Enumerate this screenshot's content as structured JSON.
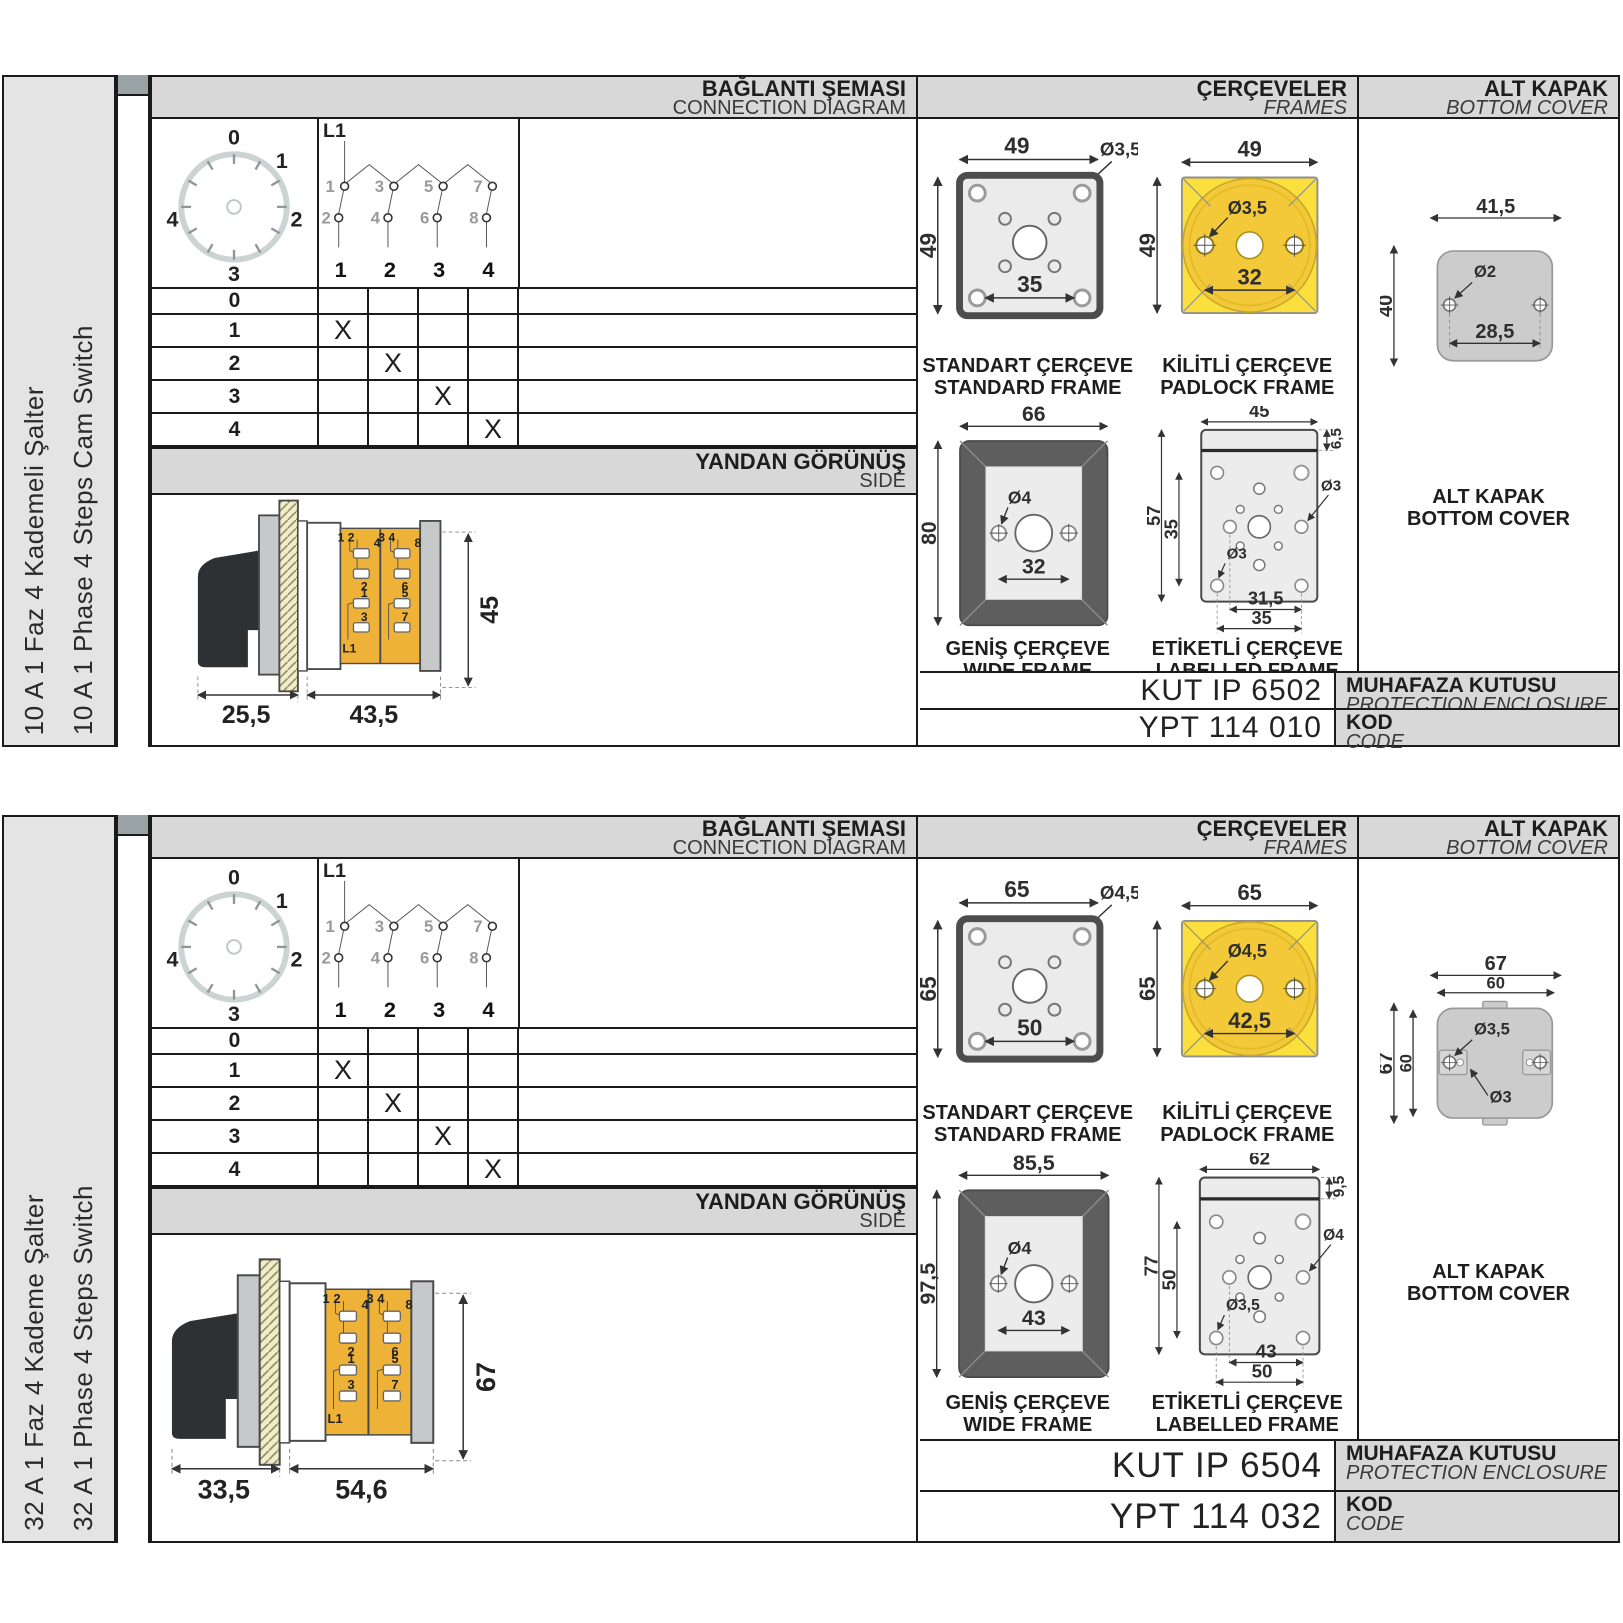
{
  "panels": [
    {
      "side_label_tr": "10 A 1 Faz 4 Kademeli Şalter",
      "side_label_en": "10 A 1 Phase 4 Steps Cam Switch",
      "headers": {
        "connection_tr": "BAĞLANTI ŞEMASI",
        "connection_en": "CONNECTION DIAGRAM",
        "frames_tr": "ÇERÇEVELER",
        "frames_en": "FRAMES",
        "cover_tr": "ALT KAPAK",
        "cover_en": "BOTTOM COVER"
      },
      "dial": {
        "positions": [
          "0",
          "1",
          "2",
          "3",
          "4"
        ]
      },
      "schematic": {
        "l1": "L1",
        "top": [
          "1",
          "3",
          "5",
          "7"
        ],
        "bottom": [
          "2",
          "4",
          "6",
          "8"
        ],
        "cols": [
          "1",
          "2",
          "3",
          "4"
        ]
      },
      "table": {
        "rows": [
          "0",
          "1",
          "2",
          "3",
          "4"
        ],
        "x_mark": "X"
      },
      "side_view": {
        "title_tr": "YANDAN GÖRÜNÜŞ",
        "title_en": "SIDE",
        "dim_front": "25,5",
        "dim_body": "43,5",
        "dim_height": "45",
        "t": {
          "pair_l": "1 2",
          "pair_r": "3 4",
          "t4": "4",
          "t2": "2",
          "t1": "1",
          "t3": "3",
          "t8": "8",
          "t6": "6",
          "t5": "5",
          "t7": "7",
          "l1": "L1"
        }
      },
      "frames": {
        "standard": {
          "caption_tr": "STANDART ÇERÇEVE",
          "caption_en": "STANDARD FRAME",
          "w": "49",
          "h": "49",
          "hole": "Ø3,5",
          "pitch": "35"
        },
        "padlock": {
          "caption_tr": "KİLİTLİ ÇERÇEVE",
          "caption_en": "PADLOCK FRAME",
          "w": "49",
          "h": "49",
          "hole": "Ø3,5",
          "pitch": "32"
        },
        "wide": {
          "caption_tr": "GENİŞ ÇERÇEVE",
          "caption_en": "WIDE FRAME",
          "w": "66",
          "h": "80",
          "hole": "Ø4",
          "pitch": "32"
        },
        "labelled": {
          "caption_tr": "ETİKETLİ ÇERÇEVE",
          "caption_en": "LABELLED FRAME",
          "w": "45",
          "strip": "6,5",
          "h": "57",
          "inner_h": "35",
          "hole_a": "Ø3",
          "hole_b": "Ø3",
          "pitch_a": "31,5",
          "pitch_b": "35"
        }
      },
      "cover": {
        "caption_tr": "ALT KAPAK",
        "caption_en": "BOTTOM COVER",
        "dim_top1": "41,5",
        "dim_left1": "40",
        "hole1": "Ø2",
        "dim_inner": "28,5"
      },
      "codes": {
        "enclosure_value": "KUT IP 6502",
        "enclosure_label_tr": "MUHAFAZA KUTUSU",
        "enclosure_label_en": "PROTECTION ENCLOSURE",
        "code_value": "YPT 114 010",
        "code_label_tr": "KOD",
        "code_label_en": "CODE"
      }
    },
    {
      "side_label_tr": "32 A 1 Faz 4 Kademe Şalter",
      "side_label_en": "32 A 1 Phase 4 Steps Switch",
      "headers": {
        "connection_tr": "BAĞLANTI ŞEMASI",
        "connection_en": "CONNECTION DIAGRAM",
        "frames_tr": "ÇERÇEVELER",
        "frames_en": "FRAMES",
        "cover_tr": "ALT KAPAK",
        "cover_en": "BOTTOM COVER"
      },
      "dial": {
        "positions": [
          "0",
          "1",
          "2",
          "3",
          "4"
        ]
      },
      "schematic": {
        "l1": "L1",
        "top": [
          "1",
          "3",
          "5",
          "7"
        ],
        "bottom": [
          "2",
          "4",
          "6",
          "8"
        ],
        "cols": [
          "1",
          "2",
          "3",
          "4"
        ]
      },
      "table": {
        "rows": [
          "0",
          "1",
          "2",
          "3",
          "4"
        ],
        "x_mark": "X"
      },
      "side_view": {
        "title_tr": "YANDAN GÖRÜNÜŞ",
        "title_en": "SIDE",
        "dim_front": "33,5",
        "dim_body": "54,6",
        "dim_height": "67",
        "t": {
          "pair_l": "1 2",
          "pair_r": "3 4",
          "t4": "4",
          "t2": "2",
          "t1": "1",
          "t3": "3",
          "t8": "8",
          "t6": "6",
          "t5": "5",
          "t7": "7",
          "l1": "L1"
        }
      },
      "frames": {
        "standard": {
          "caption_tr": "STANDART ÇERÇEVE",
          "caption_en": "STANDARD FRAME",
          "w": "65",
          "h": "65",
          "hole": "Ø4,5",
          "pitch": "50"
        },
        "padlock": {
          "caption_tr": "KİLİTLİ ÇERÇEVE",
          "caption_en": "PADLOCK FRAME",
          "w": "65",
          "h": "65",
          "hole": "Ø4,5",
          "pitch": "42,5"
        },
        "wide": {
          "caption_tr": "GENİŞ ÇERÇEVE",
          "caption_en": "WIDE FRAME",
          "w": "85,5",
          "h": "97,5",
          "hole": "Ø4",
          "pitch": "43"
        },
        "labelled": {
          "caption_tr": "ETİKETLİ ÇERÇEVE",
          "caption_en": "LABELLED FRAME",
          "w": "62",
          "strip": "9,5",
          "h": "77",
          "inner_h": "50",
          "hole_a": "Ø4",
          "hole_b": "Ø3,5",
          "pitch_a": "43",
          "pitch_b": "50"
        }
      },
      "cover": {
        "caption_tr": "ALT KAPAK",
        "caption_en": "BOTTOM COVER",
        "dim_top1": "67",
        "dim_top2": "60",
        "dim_left1": "67",
        "dim_left2": "60",
        "hole1": "Ø3,5",
        "hole2": "Ø3"
      },
      "codes": {
        "enclosure_value": "KUT IP 6504",
        "enclosure_label_tr": "MUHAFAZA KUTUSU",
        "enclosure_label_en": "PROTECTION ENCLOSURE",
        "code_value": "YPT 114 032",
        "code_label_tr": "KOD",
        "code_label_en": "CODE"
      }
    }
  ]
}
